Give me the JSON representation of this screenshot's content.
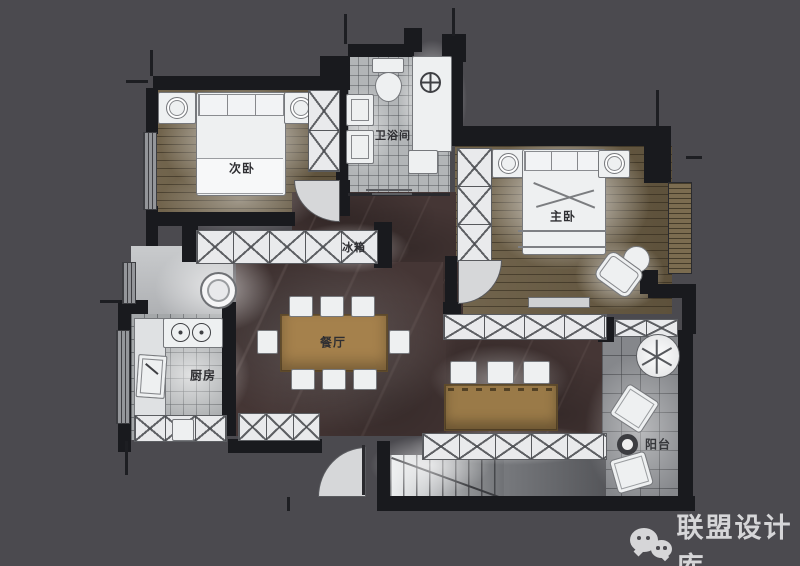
{
  "canvas": {
    "width": 800,
    "height": 566,
    "background": "#4b4a4f"
  },
  "rooms": {
    "secondary_bedroom": {
      "label": "次卧"
    },
    "bathroom": {
      "label": "卫浴间"
    },
    "master_bedroom": {
      "label": "主卧"
    },
    "fridge": {
      "label": "冰箱"
    },
    "dining": {
      "label": "餐厅"
    },
    "kitchen": {
      "label": "厨房"
    },
    "balcony": {
      "label": "阳台"
    }
  },
  "colors": {
    "background": "#4b4a4f",
    "wall": "#191a1e",
    "wood_floor": "#6a5c43",
    "marble_floor": "#453635",
    "table_wood": "#a5814c",
    "furniture_white": "#eef0f1",
    "watermark": "#d6d6d8"
  },
  "watermark": {
    "brand": "联盟设计库",
    "icon": "wechat-icon"
  }
}
